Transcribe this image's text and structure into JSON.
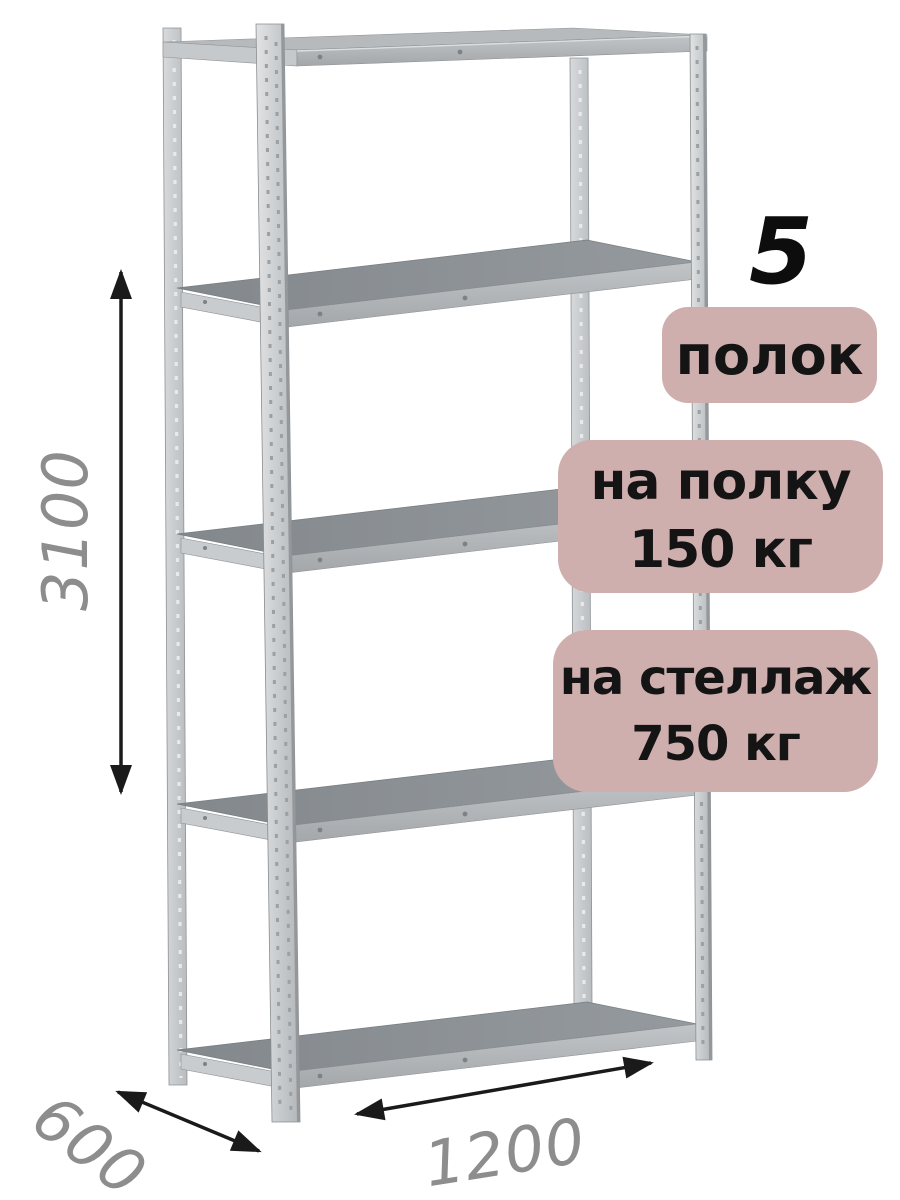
{
  "badges": {
    "shelf_count": {
      "number": "5",
      "label": "полок"
    },
    "shelf_load": {
      "line1": "на полку",
      "line2": "150 кг"
    },
    "rack_load": {
      "line1": "на стеллаж",
      "line2": "750 кг"
    }
  },
  "dimensions": {
    "height_mm": "3100",
    "depth_mm": "600",
    "width_mm": "1200"
  },
  "colors": {
    "background": "#ffffff",
    "badge_background": "#cfaeae",
    "badge_text": "#141414",
    "count_number_text": "#0d0d0d",
    "dimension_label": "#8d8d8d",
    "dimension_arrow": "#1a1a1a",
    "metal_post": "#c6c9cc",
    "shelf_surface": "#8b9094",
    "shelf_front_rail": "#aaaeb1"
  }
}
